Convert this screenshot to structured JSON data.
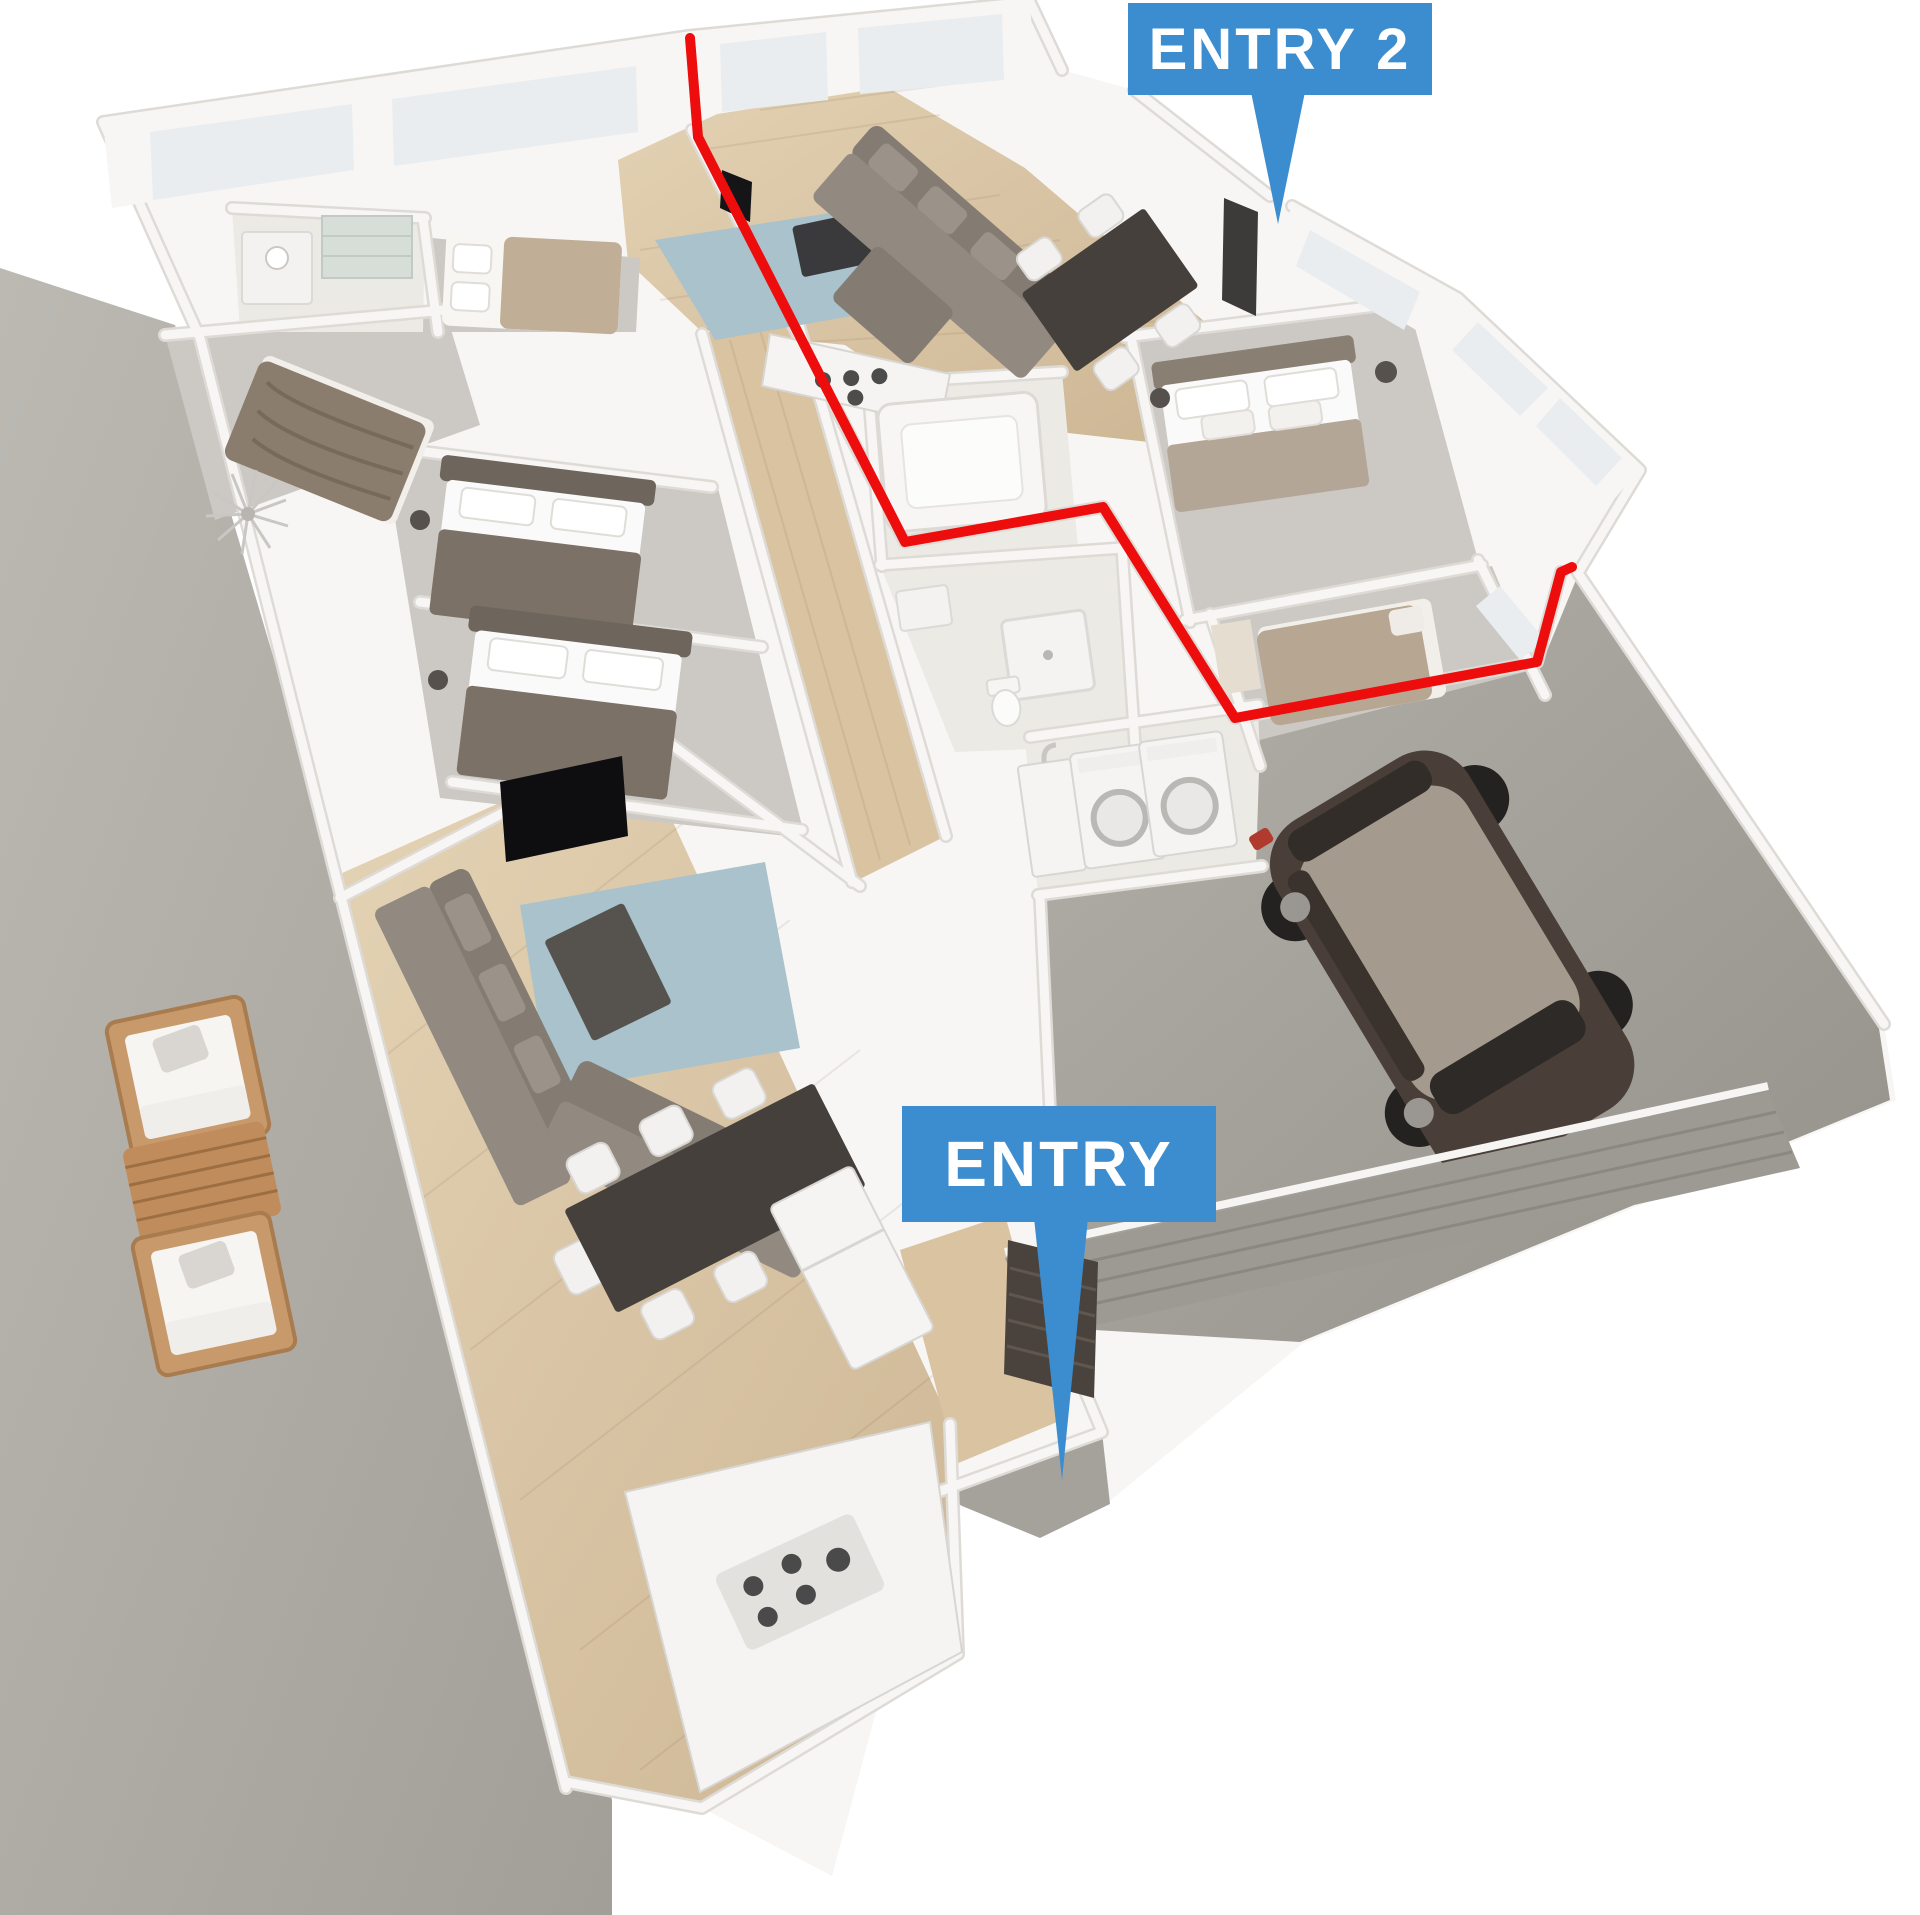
{
  "scene": {
    "description": "3D isometric architectural floor-plan render of a single-storey house; a red outline marks the suite served by the second entrance"
  },
  "annotations": {
    "entry": {
      "label": "ENTRY"
    },
    "entry2": {
      "label": "ENTRY 2"
    }
  },
  "colors": {
    "label_bg": "#3C8DD0",
    "label_text": "#FFFFFF",
    "outline_red": "#ED0D0C",
    "wall": "#F7F6F4",
    "wall_edge": "#DEDBD6",
    "window": "#E9EDF0",
    "wood": "#D9C3A1",
    "carpet": "#CCC9C4",
    "tile": "#ECEAE5",
    "concrete": "#B3B0AA",
    "garage_floor": "#A8A5A0",
    "rug": "#A9C2CB",
    "sofa": "#847C73",
    "table_dark": "#45403C",
    "appliance": "#F5F4F2",
    "car_body": "#4A3F38",
    "car_roof": "#A49B8E",
    "door_dark": "#463F39",
    "door_tan": "#D8CCB2",
    "patio_wood": "#C3925F"
  }
}
